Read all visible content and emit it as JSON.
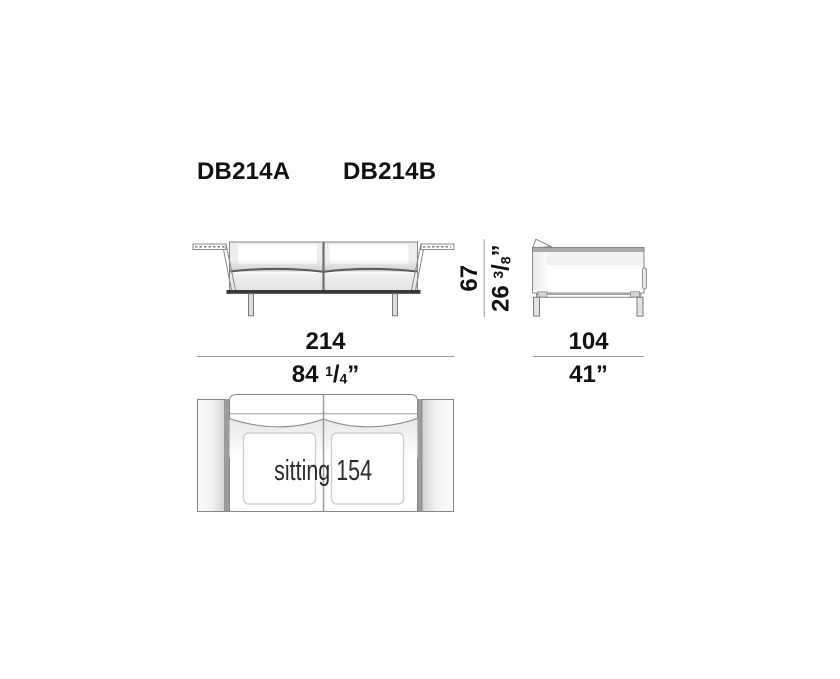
{
  "titles": {
    "model_a": "DB214A",
    "model_b": "DB214B"
  },
  "dimensions": {
    "width": {
      "cm": "214",
      "inches": {
        "pre": "84 ",
        "sup": "1",
        "slash": "/",
        "sub": "4",
        "post": "”"
      }
    },
    "depth": {
      "cm": "104",
      "inches": {
        "pre": "41",
        "sup": "",
        "slash": "",
        "sub": "",
        "post": "”"
      }
    },
    "height": {
      "cm": "67",
      "inches": {
        "pre": "26 ",
        "sup": "3",
        "slash": "/",
        "sub": "8",
        "post": "”"
      }
    }
  },
  "top_view": {
    "sitting_label": "sitting 154"
  },
  "colors": {
    "line": "#878787",
    "dark_base": "#383838",
    "dim_line": "#999999",
    "arm_strip": "#9c9c9c",
    "text": "#111111"
  }
}
